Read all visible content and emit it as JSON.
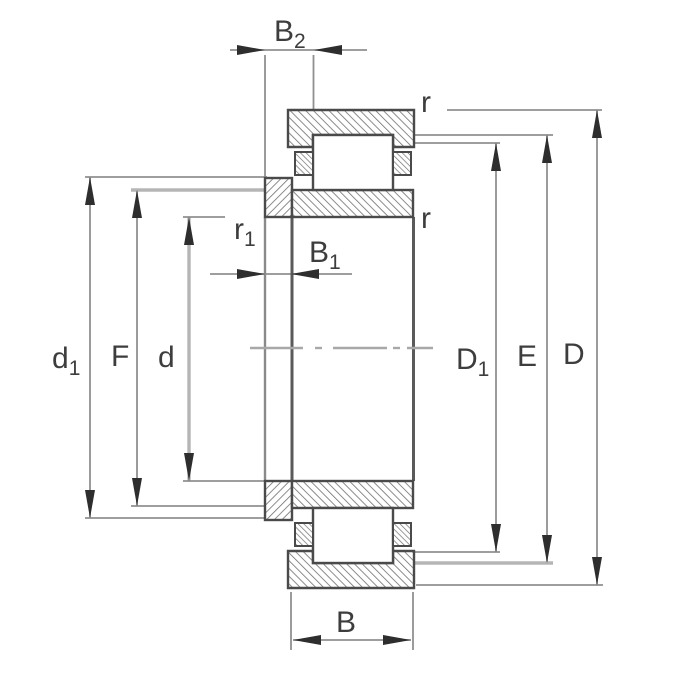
{
  "labels": {
    "b2_main": "B",
    "b2_sub": "2",
    "b1_main": "B",
    "b1_sub": "1",
    "r1_main": "r",
    "r1_sub": "1",
    "r_top": "r",
    "r_bottom": "r",
    "d1_main": "d",
    "d1_sub": "1",
    "f": "F",
    "d": "d",
    "cap_d1_main": "D",
    "cap_d1_sub": "1",
    "e": "E",
    "cap_d": "D",
    "b": "B"
  },
  "colors": {
    "background": "#ffffff",
    "part_outline": "#4a4a4a",
    "hatch": "#6f6f6f",
    "dimension_line": "#909090",
    "light_line": "#b5b5b5",
    "centerline": "#a8a8a8",
    "arrow": "#2e2e2e",
    "text": "#3d3d3d"
  }
}
